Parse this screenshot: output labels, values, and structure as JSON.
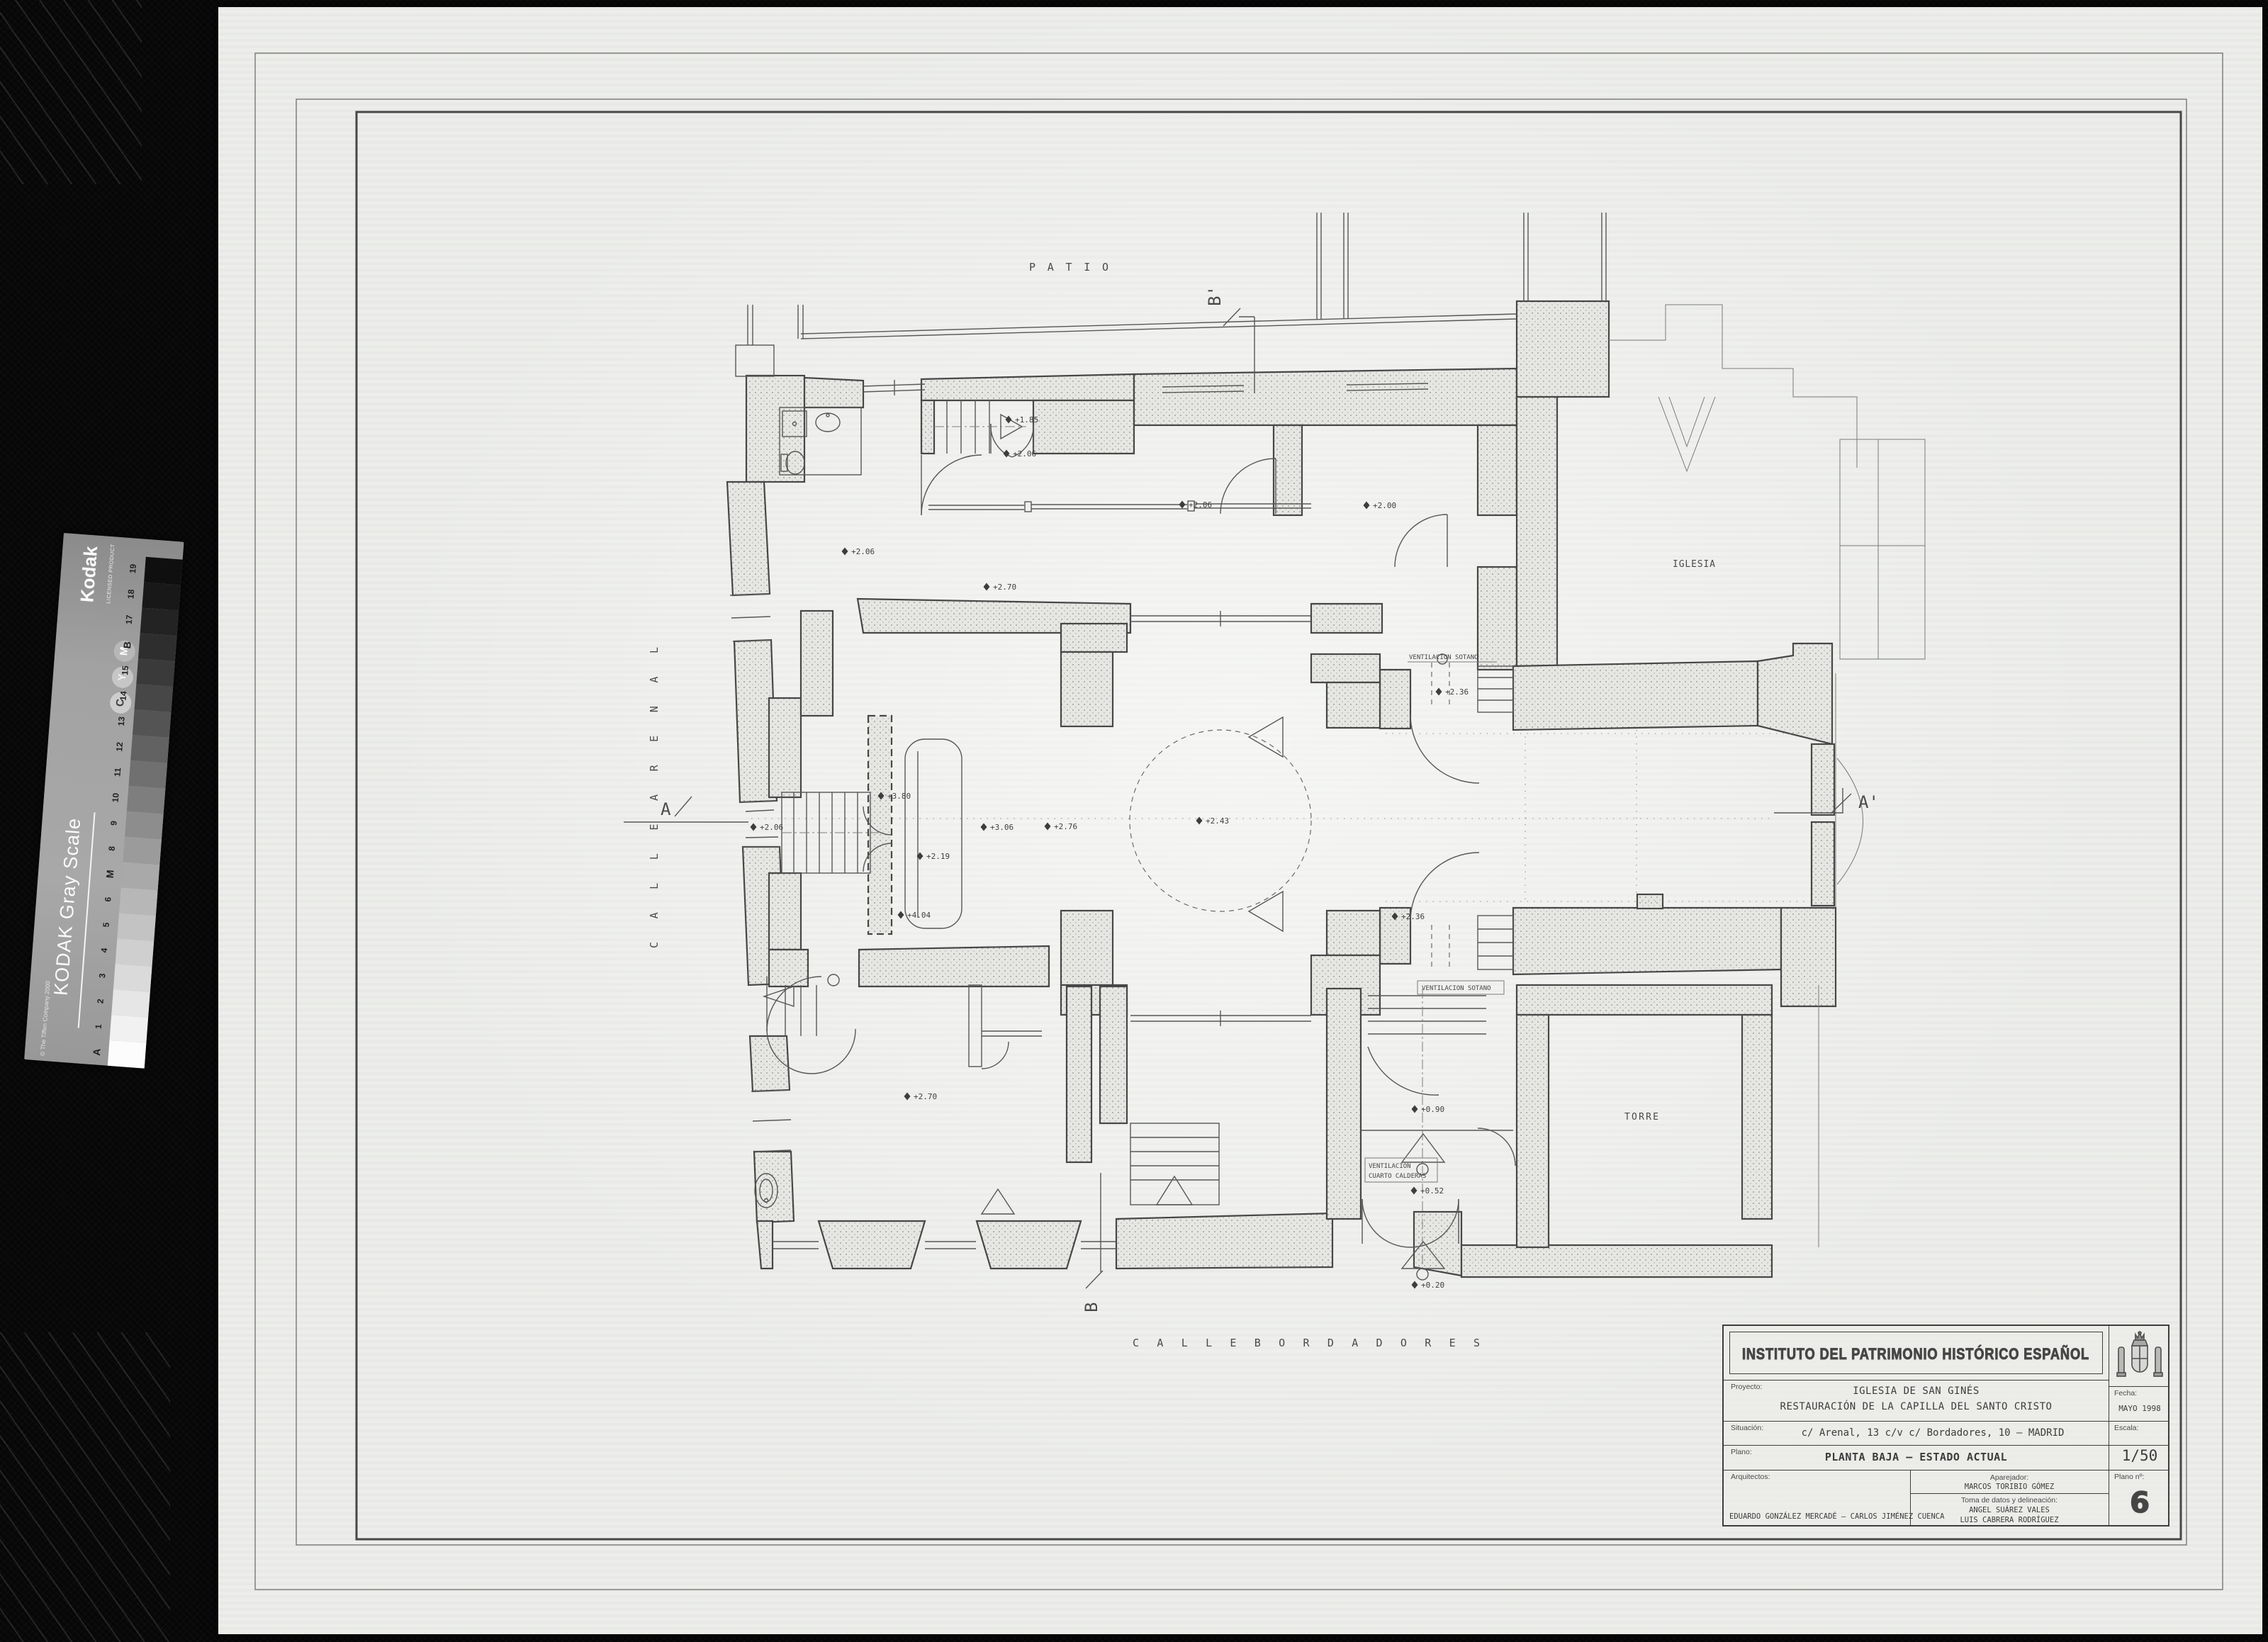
{
  "colors": {
    "film_black": "#070707",
    "paper": "#ecedea",
    "ink": "#454545",
    "hatch_dot": "#969696"
  },
  "kodak": {
    "brand": "Kodak",
    "licensed": "LICENSED PRODUCT",
    "title": "KODAK Gray Scale",
    "copyright": "© The Tiffen Company 2000",
    "letters": {
      "c": "C",
      "y": "Y",
      "m": "M"
    },
    "scale_labels": [
      "A",
      "1",
      "2",
      "3",
      "4",
      "5",
      "6",
      "M",
      "8",
      "9",
      "10",
      "11",
      "12",
      "13",
      "14",
      "15",
      "B",
      "17",
      "18",
      "19"
    ],
    "patch_grays": [
      "#fcfcfc",
      "#f1f1f1",
      "#e6e6e6",
      "#dadada",
      "#cfcfcf",
      "#c3c3c3",
      "#b7b7b7",
      "#a9a9a9",
      "#9b9b9b",
      "#8d8d8d",
      "#7e7e7e",
      "#707070",
      "#626262",
      "#545454",
      "#474747",
      "#3a3a3a",
      "#2e2e2e",
      "#232323",
      "#181818",
      "#0f0f0f"
    ]
  },
  "plan": {
    "labels": {
      "patio": "P A T I O",
      "iglesia": "IGLESIA",
      "torre": "TORRE",
      "calle_arenal": "C A L L E     A R E N A L",
      "calle_bordadores": "C A L L E     B O R D A D O R E S",
      "section_a": "A",
      "section_a_prime": "A'",
      "section_b": "B",
      "section_b_prime": "B'",
      "vent_sotano_top": "VENTILACION  SOTANO",
      "vent_sotano_low": "VENTILACION  SOTANO",
      "vent_calderas_1": "VENTILACION",
      "vent_calderas_2": "CUARTO CALDERAS"
    },
    "markers": [
      {
        "label": "+1.85"
      },
      {
        "label": "+2.06"
      },
      {
        "label": "+2.06"
      },
      {
        "label": "+2.70"
      },
      {
        "label": "+2.06"
      },
      {
        "label": "+2.00"
      },
      {
        "label": "+2.36"
      },
      {
        "label": "+3.80"
      },
      {
        "label": "+2.06"
      },
      {
        "label": "+3.06"
      },
      {
        "label": "+2.76"
      },
      {
        "label": "+2.19"
      },
      {
        "label": "+2.43"
      },
      {
        "label": "+4.04"
      },
      {
        "label": "+2.36"
      },
      {
        "label": "+0.90"
      },
      {
        "label": "+0.52"
      },
      {
        "label": "+0.20"
      },
      {
        "label": "+2.70"
      }
    ]
  },
  "titleblock": {
    "institute": "INSTITUTO DEL PATRIMONIO HISTÓRICO ESPAÑOL",
    "proyecto_label": "Proyecto:",
    "proyecto_line1": "IGLESIA DE SAN GINÉS",
    "proyecto_line2": "RESTAURACIÓN DE LA CAPILLA DEL SANTO CRISTO",
    "fecha_label": "Fecha:",
    "fecha_value": "MAYO 1998",
    "situacion_label": "Situación:",
    "situacion_value": "c/ Arenal, 13 c/v c/ Bordadores, 10 – MADRID",
    "escala_label": "Escala:",
    "escala_value": "1/50",
    "plano_label": "Plano:",
    "plano_value": "PLANTA BAJA – ESTADO ACTUAL",
    "arquitectos_label": "Arquitectos:",
    "arquitectos_value": "EDUARDO GONZÁLEZ MERCADÉ  –  CARLOS JIMÉNEZ CUENCA",
    "aparejador_label": "Aparejador:",
    "aparejador_value": "MARCOS TORIBIO GÓMEZ",
    "toma_label": "Toma de datos y delineación:",
    "toma_value1": "ANGEL SUÁREZ VALES",
    "toma_value2": "LUIS CABRERA RODRÍGUEZ",
    "plano_num_label": "Plano nº:",
    "plano_num_value": "6"
  }
}
